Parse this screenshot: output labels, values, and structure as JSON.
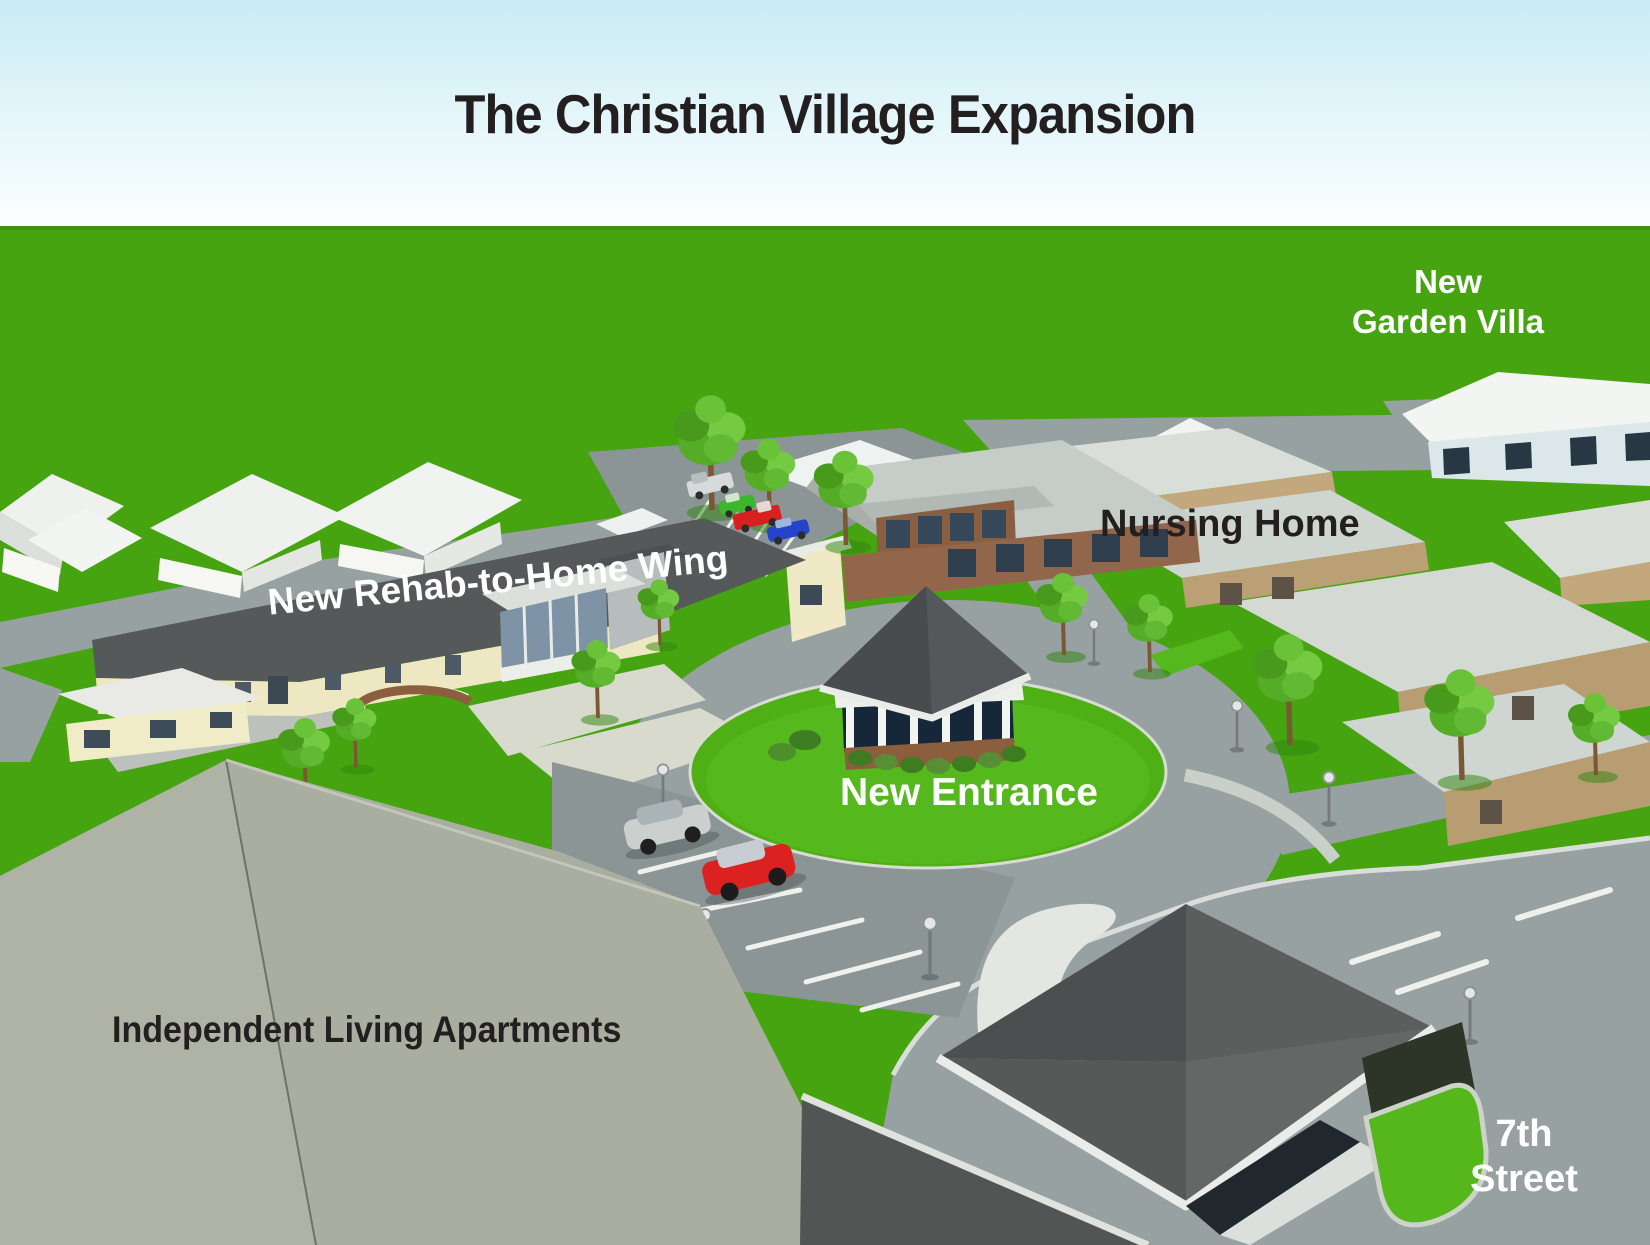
{
  "title": "The Christian Village Expansion",
  "labels": {
    "garden_villa_line1": "New",
    "garden_villa_line2": "Garden Villa",
    "nursing_home": "Nursing Home",
    "rehab_wing": "New Rehab-to-Home Wing",
    "new_entrance": "New Entrance",
    "independent_living": "Independent Living Apartments",
    "street_line1": "7th",
    "street_line2": "Street"
  },
  "colors": {
    "sky_top": "#cdedf6",
    "sky_horizon": "#fbfeff",
    "grass": "#47a411",
    "grass_bright": "#55b81c",
    "road": "#97a1a2",
    "road_dark": "#8b9596",
    "sidewalk": "#e2e5df",
    "paver": "#d7dacd",
    "roof_dark": "#56595a",
    "roof_white": "#f0f3f0",
    "roof_light": "#d4d9d4",
    "roof_sage": "#a9aea0",
    "wall_cream": "#efe9c4",
    "wall_tan": "#c0a379",
    "brick": "#8b5f3d",
    "tree_green": "#6cc03a",
    "label_dark": "#231f20",
    "label_white": "#ffffff",
    "car_red": "#dc2121",
    "car_blue": "#2544ca",
    "car_green": "#3cb62d",
    "car_silver": "#cbcfce"
  }
}
